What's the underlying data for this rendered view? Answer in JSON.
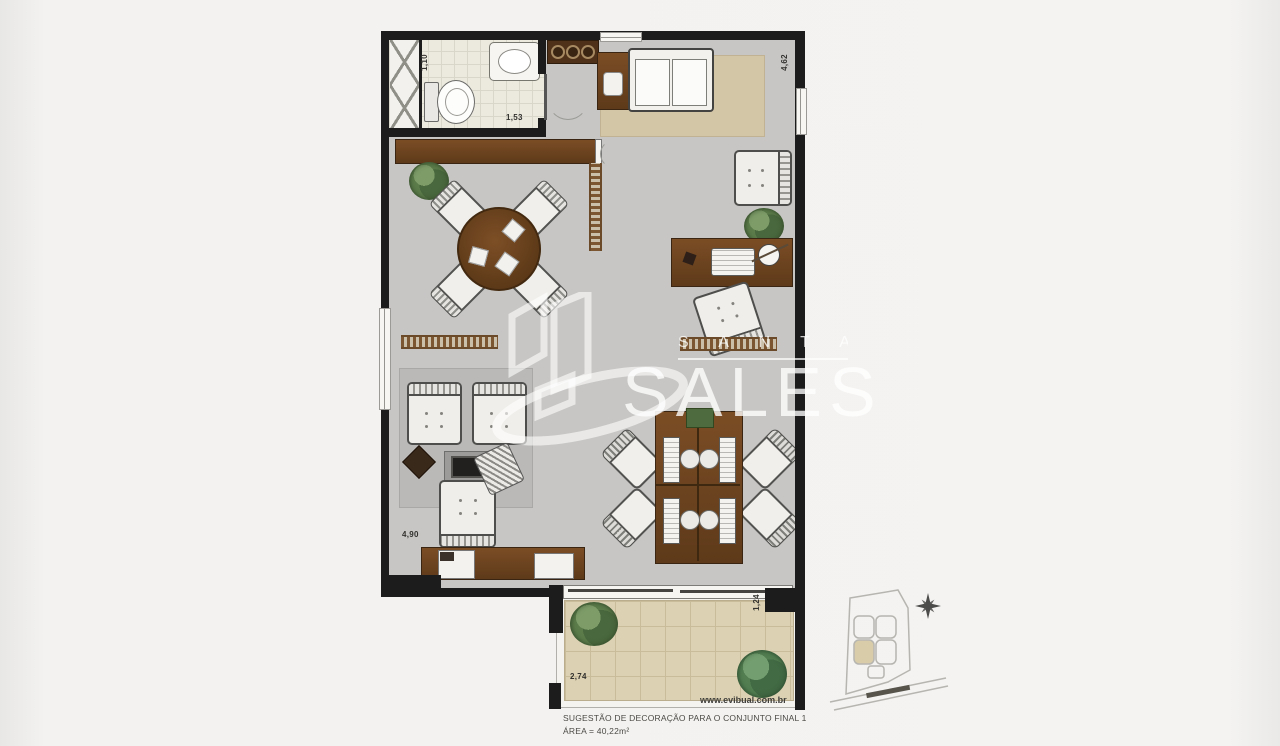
{
  "watermark": {
    "brand_top": "S A N T A",
    "brand_main": "SALES"
  },
  "caption": {
    "website": "www.evibual.com.br",
    "title": "SUGESTÃO DE DECORAÇÃO PARA O CONJUNTO FINAL 1",
    "area": "ÁREA = 40,22m²"
  },
  "dimensions": {
    "bathroom_width": "1,10",
    "bathroom_length": "1,53",
    "living_depth": "4,62",
    "room_width": "4,90",
    "terrace_width": "2,74",
    "terrace_depth": "1,24"
  }
}
